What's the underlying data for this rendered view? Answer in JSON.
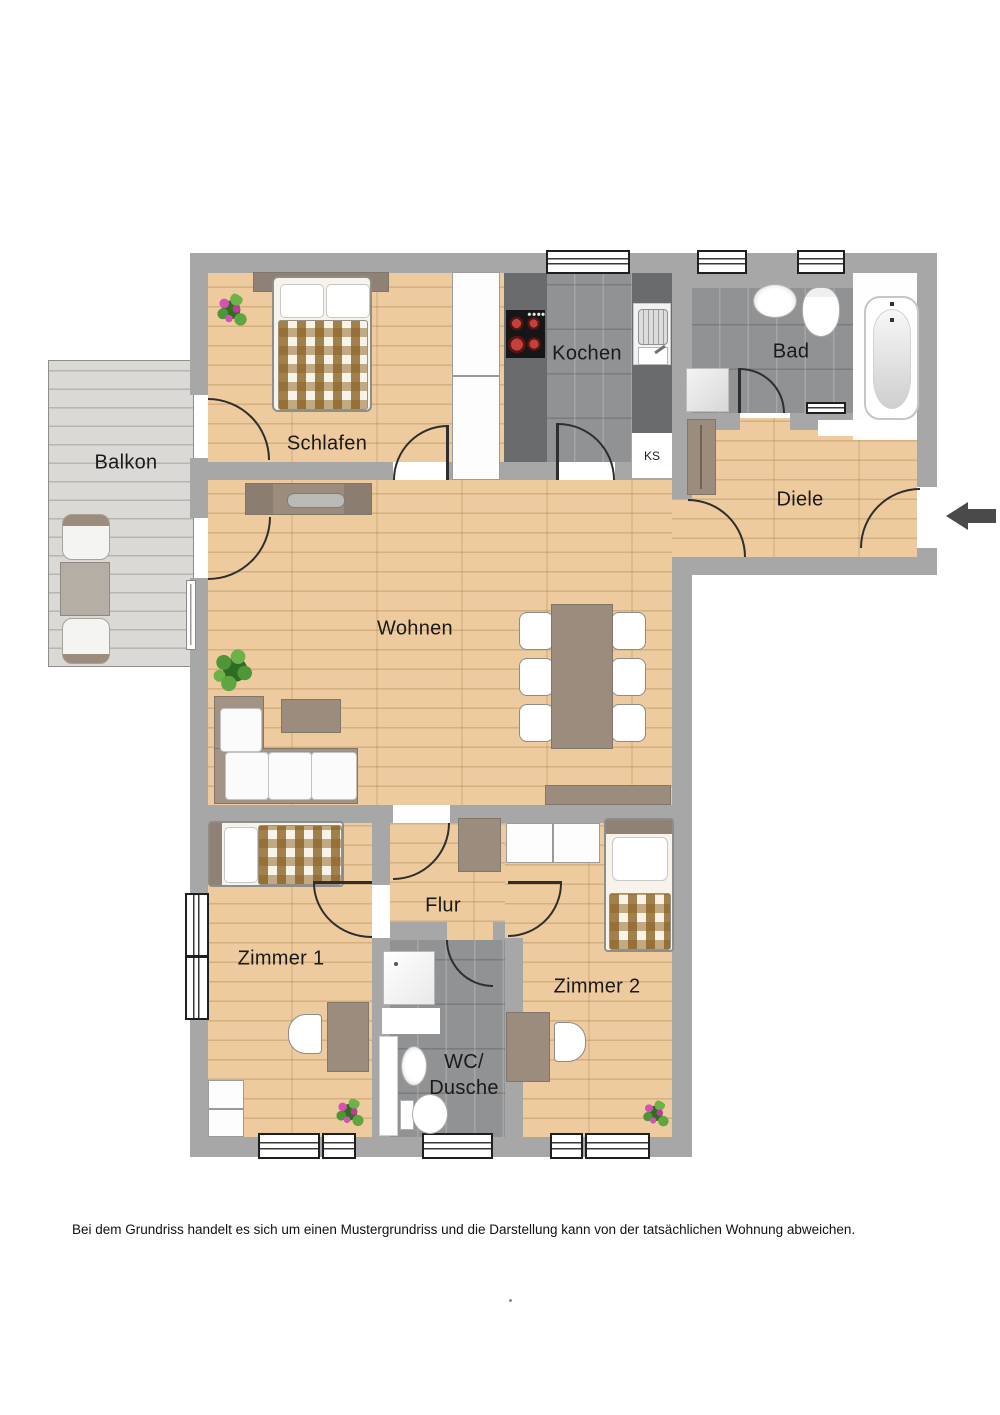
{
  "floor_plan": {
    "room_labels": {
      "balkon": "Balkon",
      "schlafen": "Schlafen",
      "kochen": "Kochen",
      "bad": "Bad",
      "diele": "Diele",
      "wohnen": "Wohnen",
      "flur": "Flur",
      "zimmer1": "Zimmer 1",
      "zimmer2": "Zimmer 2",
      "wc_line1": "WC/",
      "wc_line2": "Dusche"
    },
    "rooms": [
      "Balkon",
      "Schlafen",
      "Kochen",
      "Bad",
      "Diele",
      "Wohnen",
      "Flur",
      "Zimmer 1",
      "Zimmer 2",
      "WC/Dusche"
    ],
    "fridge_label": "KS",
    "disclaimer": "Bei dem Grundriss handelt es sich um einen Mustergrundriss und die Darstellung kann von der tatsächlichen Wohnung abweichen.",
    "colors": {
      "wall": "#a7a7a7",
      "wood_floor": "#edcb9e",
      "tile_floor": "#909294",
      "balcony_deck": "#dbd9d5",
      "furniture_taupe": "#9c8c7e",
      "kitchen_counter": "#696b6c",
      "blanket_checker": "#8a6020",
      "entrance_arrow": "#4a4a4a"
    }
  }
}
